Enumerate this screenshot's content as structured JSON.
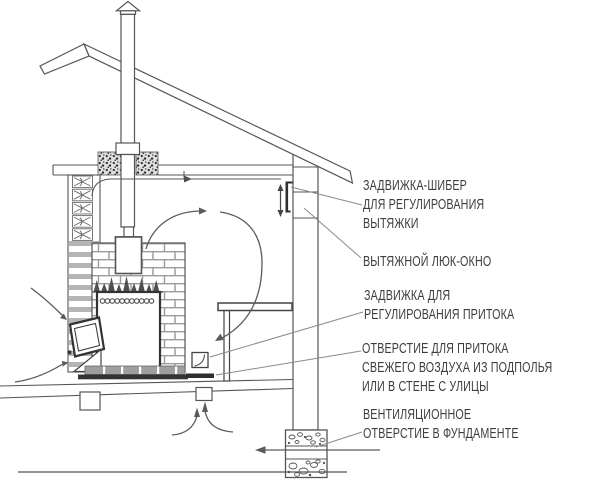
{
  "figure": {
    "labels": {
      "exhaust_damper": [
        "ЗАДВИЖКА-ШИБЕР",
        "ДЛЯ РЕГУЛИРОВАНИЯ",
        "ВЫТЯЖКИ"
      ],
      "exhaust_hatch": [
        "ВЫТЯЖНОЙ ЛЮК-ОКНО"
      ],
      "intake_damper": [
        "ЗАДВИЖКА ДЛЯ",
        "РЕГУЛИРОВАНИЯ ПРИТОКА"
      ],
      "intake_opening": [
        "ОТВЕРСТИЕ ДЛЯ ПРИТОКА",
        "СВЕЖЕГО ВОЗДУХА ИЗ ПОДПОЛЬЯ",
        "ИЛИ В СТЕНЕ С УЛИЦЫ"
      ],
      "foundation_vent": [
        "ВЕНТИЛЯЦИОННОЕ",
        "ОТВЕРСТИЕ В ФУНДАМЕНТЕ"
      ]
    },
    "colors": {
      "line": "#4f4f4f",
      "text": "#3d3d3d",
      "background": "#ffffff"
    }
  }
}
